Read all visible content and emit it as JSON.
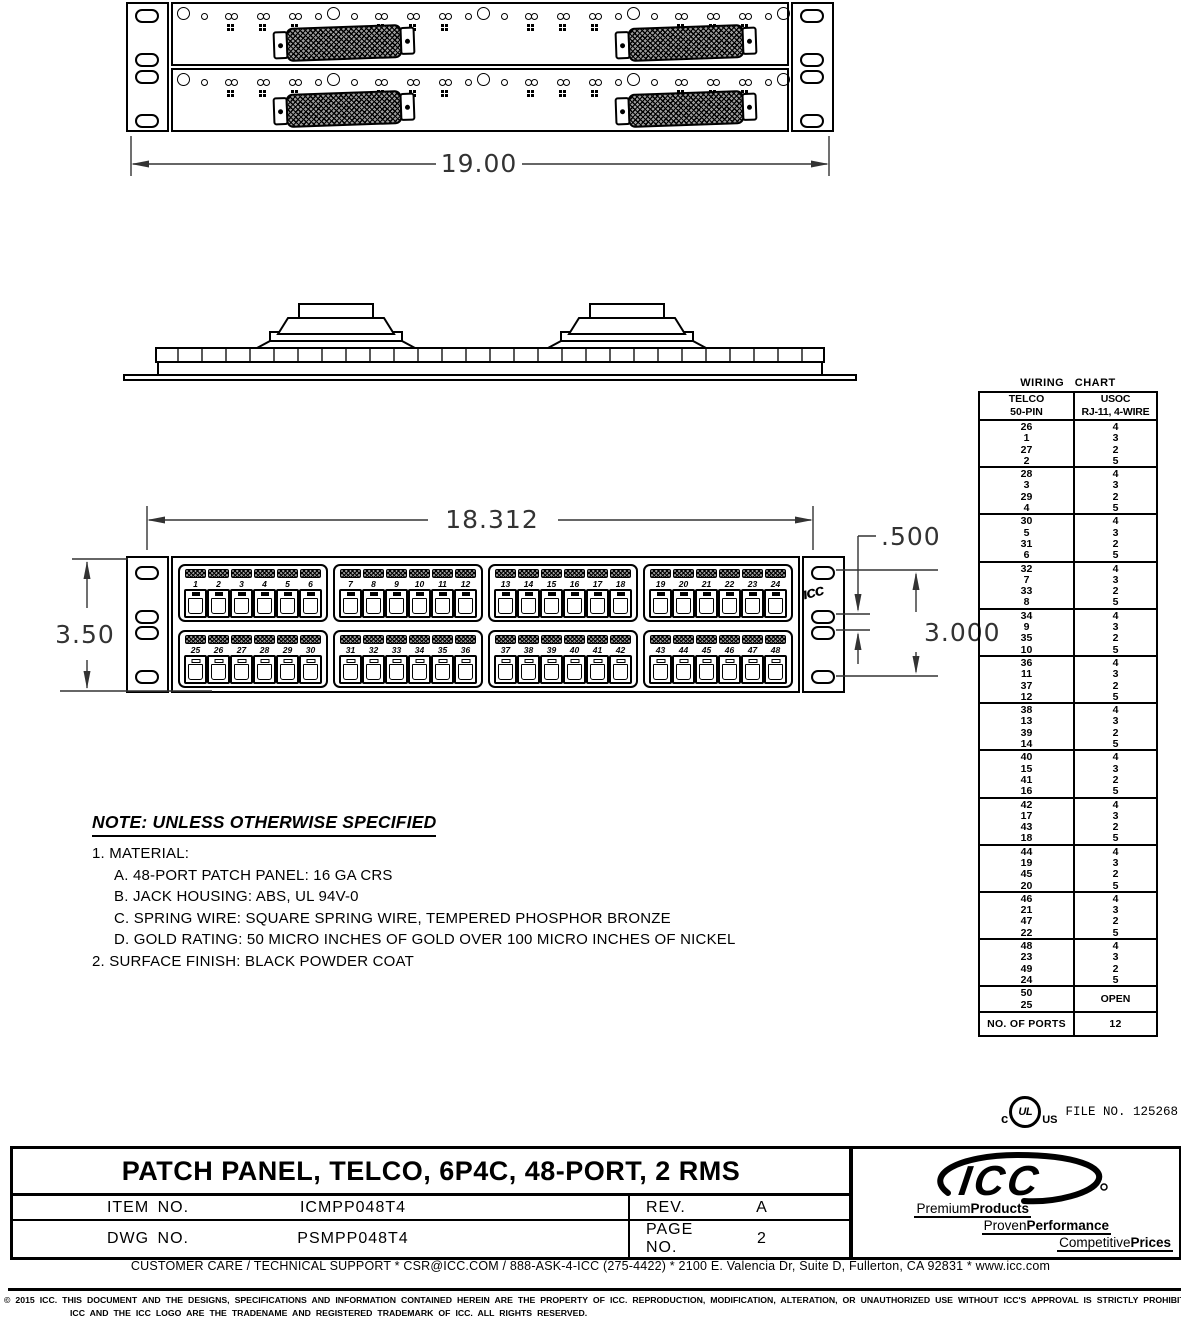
{
  "dimensions": {
    "overall_width": "19.00",
    "jack_span": "18.312",
    "ear_hole_offset": ".500",
    "panel_height": "3.50",
    "mount_hole_span": "3.000"
  },
  "front_view": {
    "panel_brand": "ICC",
    "rows": [
      [
        [
          "1",
          "2",
          "3",
          "4",
          "5",
          "6"
        ],
        [
          "7",
          "8",
          "9",
          "10",
          "11",
          "12"
        ],
        [
          "13",
          "14",
          "15",
          "16",
          "17",
          "18"
        ],
        [
          "19",
          "20",
          "21",
          "22",
          "23",
          "24"
        ]
      ],
      [
        [
          "25",
          "26",
          "27",
          "28",
          "29",
          "30"
        ],
        [
          "31",
          "32",
          "33",
          "34",
          "35",
          "36"
        ],
        [
          "37",
          "38",
          "39",
          "40",
          "41",
          "42"
        ],
        [
          "43",
          "44",
          "45",
          "46",
          "47",
          "48"
        ]
      ]
    ]
  },
  "wiring_chart": {
    "title": "WIRING CHART",
    "col1_header": [
      "TELCO",
      "50-PIN"
    ],
    "col2_header": [
      "USOC",
      "RJ-11, 4-WIRE"
    ],
    "groups": [
      {
        "telco": [
          "26",
          "1",
          "27",
          "2"
        ],
        "usoc": [
          "4",
          "3",
          "2",
          "5"
        ]
      },
      {
        "telco": [
          "28",
          "3",
          "29",
          "4"
        ],
        "usoc": [
          "4",
          "3",
          "2",
          "5"
        ]
      },
      {
        "telco": [
          "30",
          "5",
          "31",
          "6"
        ],
        "usoc": [
          "4",
          "3",
          "2",
          "5"
        ]
      },
      {
        "telco": [
          "32",
          "7",
          "33",
          "8"
        ],
        "usoc": [
          "4",
          "3",
          "2",
          "5"
        ]
      },
      {
        "telco": [
          "34",
          "9",
          "35",
          "10"
        ],
        "usoc": [
          "4",
          "3",
          "2",
          "5"
        ]
      },
      {
        "telco": [
          "36",
          "11",
          "37",
          "12"
        ],
        "usoc": [
          "4",
          "3",
          "2",
          "5"
        ]
      },
      {
        "telco": [
          "38",
          "13",
          "39",
          "14"
        ],
        "usoc": [
          "4",
          "3",
          "2",
          "5"
        ]
      },
      {
        "telco": [
          "40",
          "15",
          "41",
          "16"
        ],
        "usoc": [
          "4",
          "3",
          "2",
          "5"
        ]
      },
      {
        "telco": [
          "42",
          "17",
          "43",
          "18"
        ],
        "usoc": [
          "4",
          "3",
          "2",
          "5"
        ]
      },
      {
        "telco": [
          "44",
          "19",
          "45",
          "20"
        ],
        "usoc": [
          "4",
          "3",
          "2",
          "5"
        ]
      },
      {
        "telco": [
          "46",
          "21",
          "47",
          "22"
        ],
        "usoc": [
          "4",
          "3",
          "2",
          "5"
        ]
      },
      {
        "telco": [
          "48",
          "23",
          "49",
          "24"
        ],
        "usoc": [
          "4",
          "3",
          "2",
          "5"
        ]
      }
    ],
    "open_group": {
      "telco": [
        "50",
        "25"
      ],
      "usoc": "OPEN"
    },
    "footer": {
      "label": "NO. OF PORTS",
      "value": "12"
    }
  },
  "notes": {
    "heading": "NOTE: UNLESS OTHERWISE SPECIFIED",
    "lines": [
      "1. MATERIAL:",
      "A. 48-PORT PATCH PANEL: 16 GA CRS",
      "B. JACK HOUSING: ABS, UL 94V-0",
      "C. SPRING WIRE: SQUARE SPRING WIRE, TEMPERED PHOSPHOR BRONZE",
      "D. GOLD RATING: 50 MICRO INCHES OF GOLD OVER 100 MICRO INCHES OF NICKEL",
      "2. SURFACE FINISH: BLACK POWDER COAT"
    ]
  },
  "certification": {
    "ul_c": "c",
    "ul_letters": "UL",
    "ul_us": "US",
    "file_no": "FILE NO. 125268"
  },
  "title_block": {
    "title": "PATCH PANEL, TELCO, 6P4C, 48-PORT, 2 RMS",
    "item_label": "ITEM NO.",
    "item_value": "ICMPP048T4",
    "dwg_label": "DWG NO.",
    "dwg_value": "PSMPP048T4",
    "rev_label": "REV.",
    "rev_value": "A",
    "page_label": "PAGE NO.",
    "page_value": "2"
  },
  "brand_box": {
    "logo_text": "ICC",
    "taglines": [
      {
        "light": "Premium",
        "bold": "Products"
      },
      {
        "light": "Proven",
        "bold": "Performance"
      },
      {
        "light": "Competitive",
        "bold": "Prices"
      }
    ]
  },
  "footer": {
    "support_line": "CUSTOMER CARE / TECHNICAL SUPPORT * CSR@ICC.COM / 888-ASK-4-ICC (275-4422) * 2100 E. Valencia Dr, Suite D, Fullerton, CA 92831 * www.icc.com",
    "copyright_line1": "© 2015 ICC. THIS DOCUMENT AND THE DESIGNS, SPECIFICATIONS AND INFORMATION CONTAINED HEREIN ARE THE PROPERTY OF ICC. REPRODUCTION, MODIFICATION, ALTERATION, OR UNAUTHORIZED USE WITHOUT ICC'S APPROVAL IS STRICTLY PROHIBITED.",
    "copyright_line2": "ICC AND THE ICC LOGO ARE THE TRADENAME AND REGISTERED TRADEMARK OF ICC.  ALL RIGHTS RESERVED."
  }
}
